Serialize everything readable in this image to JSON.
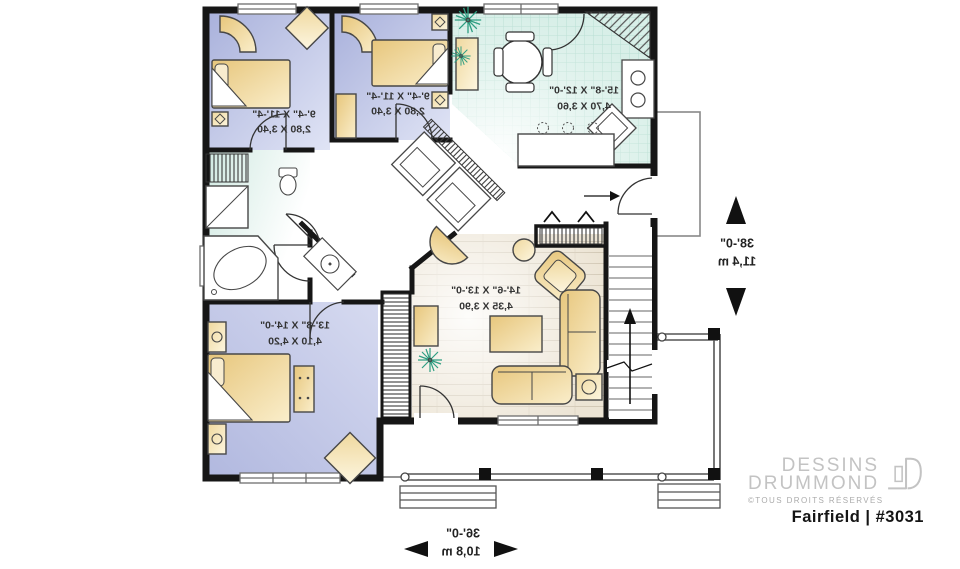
{
  "plan": {
    "labels_mirrored": true,
    "rooms": [
      {
        "id": "bedroom-1",
        "imperial": "9'-4\" X 11'-4\"",
        "metric": "2,80 X 3,40"
      },
      {
        "id": "bedroom-2",
        "imperial": "9'-4\" X 11'-4\"",
        "metric": "2,80 X 3,40"
      },
      {
        "id": "kitchen-dining",
        "imperial": "15'-8\" X 12'-0\"",
        "metric": "4,70 X 3,60"
      },
      {
        "id": "living-room",
        "imperial": "14'-6\" X 13'-0\"",
        "metric": "4,35 X 3,90"
      },
      {
        "id": "master-bedroom",
        "imperial": "13'-8\" X 14'-0\"",
        "metric": "4,10 X 4,20"
      }
    ],
    "overall_depth": {
      "imperial": "38'-0\"",
      "metric": "11,4 m"
    },
    "overall_width": {
      "imperial": "36'-0\"",
      "metric": "10,8 m"
    }
  },
  "branding": {
    "name_line1": "DESSINS",
    "name_line2": "DRUMMOND",
    "rights": "©TOUS DROITS RÉSERVÉS",
    "model": "Fairfield | #3031"
  },
  "colors": {
    "bedroom_fill": "#aab1dc",
    "bedroom_fill_light": "#dfe3f4",
    "kitchen_fill": "#d8efe8",
    "kitchen_grid": "#b9dfd3",
    "bath_fill": "#d5ebe4",
    "living_fill": "#ece4d4",
    "furniture_tan": "#e7c67c",
    "wall": "#161616",
    "plant_green": "#2f9e82",
    "logo_gray": "#c3c3c3"
  }
}
